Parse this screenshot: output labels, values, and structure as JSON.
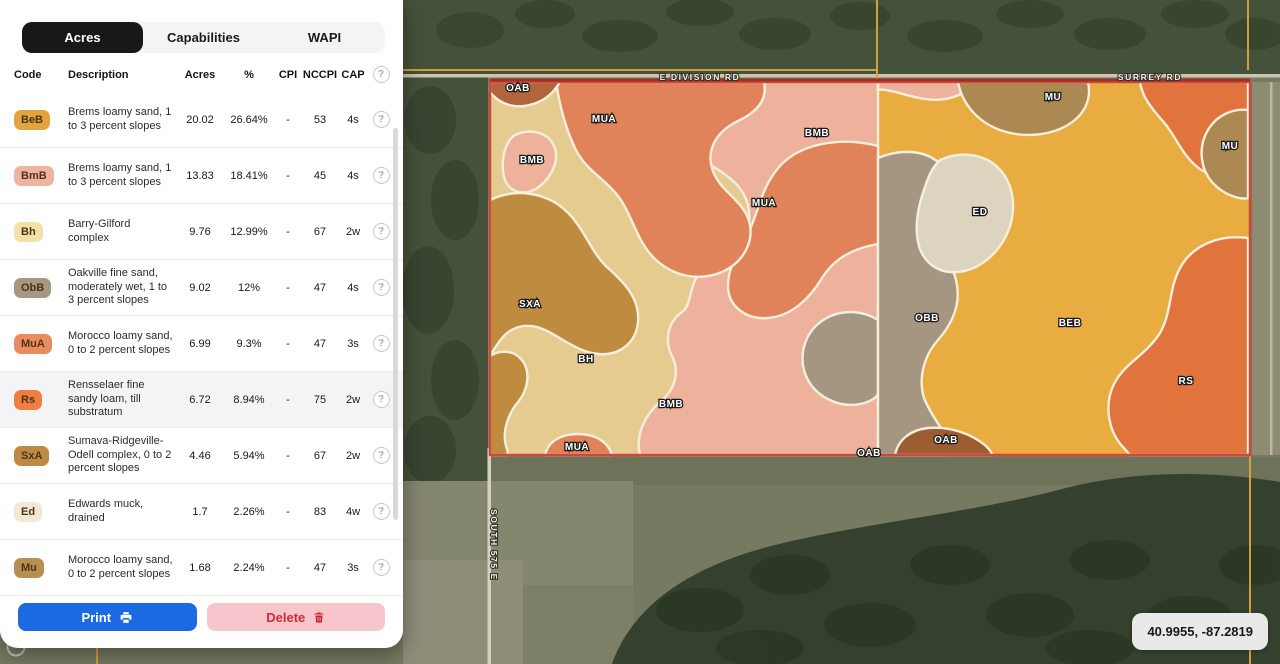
{
  "panel": {
    "tabs": [
      {
        "label": "Acres",
        "active": true
      },
      {
        "label": "Capabilities",
        "active": false
      },
      {
        "label": "WAPI",
        "active": false
      }
    ],
    "table": {
      "headers": [
        "Code",
        "Description",
        "Acres",
        "%",
        "CPI",
        "NCCPI",
        "CAP"
      ],
      "rows": [
        {
          "code": "BeB",
          "color": "#e2a43e",
          "description": "Brems loamy sand, 1 to 3 percent slopes",
          "acres": "20.02",
          "pct": "26.64%",
          "cpi": "-",
          "nccpi": "53",
          "cap": "4s",
          "highlight": false
        },
        {
          "code": "BmB",
          "color": "#eeb3a1",
          "description": "Brems loamy sand, 1 to 3 percent slopes",
          "acres": "13.83",
          "pct": "18.41%",
          "cpi": "-",
          "nccpi": "45",
          "cap": "4s",
          "highlight": false
        },
        {
          "code": "Bh",
          "color": "#f4e1a8",
          "description": "Barry-Gilford complex",
          "acres": "9.76",
          "pct": "12.99%",
          "cpi": "-",
          "nccpi": "67",
          "cap": "2w",
          "highlight": false
        },
        {
          "code": "ObB",
          "color": "#a79682",
          "description": "Oakville fine sand, moderately wet, 1 to 3 percent slopes",
          "acres": "9.02",
          "pct": "12%",
          "cpi": "-",
          "nccpi": "47",
          "cap": "4s",
          "highlight": false
        },
        {
          "code": "MuA",
          "color": "#eb8b60",
          "description": "Morocco loamy sand, 0 to 2 percent slopes",
          "acres": "6.99",
          "pct": "9.3%",
          "cpi": "-",
          "nccpi": "47",
          "cap": "3s",
          "highlight": false
        },
        {
          "code": "Rs",
          "color": "#ed7f43",
          "description": "Rensselaer fine sandy loam, till substratum",
          "acres": "6.72",
          "pct": "8.94%",
          "cpi": "-",
          "nccpi": "75",
          "cap": "2w",
          "highlight": true
        },
        {
          "code": "SxA",
          "color": "#bd8a46",
          "description": "Sumava-Ridgeville-Odell complex, 0 to 2 percent slopes",
          "acres": "4.46",
          "pct": "5.94%",
          "cpi": "-",
          "nccpi": "67",
          "cap": "2w",
          "highlight": false
        },
        {
          "code": "Ed",
          "color": "#f3e8d3",
          "description": "Edwards muck, drained",
          "acres": "1.7",
          "pct": "2.26%",
          "cpi": "-",
          "nccpi": "83",
          "cap": "4w",
          "highlight": false
        },
        {
          "code": "Mu",
          "color": "#b68f53",
          "description": "Morocco loamy sand, 0 to 2 percent slopes",
          "acres": "1.68",
          "pct": "2.24%",
          "cpi": "-",
          "nccpi": "47",
          "cap": "3s",
          "highlight": false
        }
      ]
    },
    "buttons": {
      "print": "Print",
      "delete": "Delete"
    }
  },
  "map": {
    "coordinates": "40.9955, -87.2819",
    "road_labels": [
      {
        "text": "E DIVISION RD",
        "x": 700,
        "y": 80,
        "rotate": 0
      },
      {
        "text": "SURREY RD",
        "x": 1150,
        "y": 80,
        "rotate": 0
      },
      {
        "text": "SOUTH 575 E",
        "x": 491,
        "y": 545,
        "rotate": 90
      }
    ],
    "soil_labels": [
      {
        "text": "OAB",
        "x": 518,
        "y": 91
      },
      {
        "text": "MUA",
        "x": 604,
        "y": 122
      },
      {
        "text": "BMB",
        "x": 817,
        "y": 136
      },
      {
        "text": "MU",
        "x": 1053,
        "y": 100
      },
      {
        "text": "MU",
        "x": 1230,
        "y": 149
      },
      {
        "text": "BMB",
        "x": 532,
        "y": 163
      },
      {
        "text": "MUA",
        "x": 764,
        "y": 206
      },
      {
        "text": "ED",
        "x": 980,
        "y": 215
      },
      {
        "text": "SXA",
        "x": 530,
        "y": 307
      },
      {
        "text": "OBB",
        "x": 927,
        "y": 321
      },
      {
        "text": "BEB",
        "x": 1070,
        "y": 326
      },
      {
        "text": "BH",
        "x": 586,
        "y": 362
      },
      {
        "text": "RS",
        "x": 1186,
        "y": 384
      },
      {
        "text": "BMB",
        "x": 671,
        "y": 407
      },
      {
        "text": "OAB",
        "x": 946,
        "y": 443
      },
      {
        "text": "MUA",
        "x": 577,
        "y": 450
      },
      {
        "text": "OAB",
        "x": 869,
        "y": 456
      }
    ],
    "soil_colors": {
      "base_tan": "#e5cb90",
      "base_gold": "#e9ac41",
      "orange": "#e0835a",
      "pink": "#eeb29c",
      "brown": "#bf8b3e",
      "taupe": "#a59682",
      "cream": "#dcd4bf",
      "mu_brown": "#ac8852",
      "rs_orange": "#e1743c",
      "dark_rust": "#b2643a",
      "dark_oab": "#9d5c31"
    }
  }
}
